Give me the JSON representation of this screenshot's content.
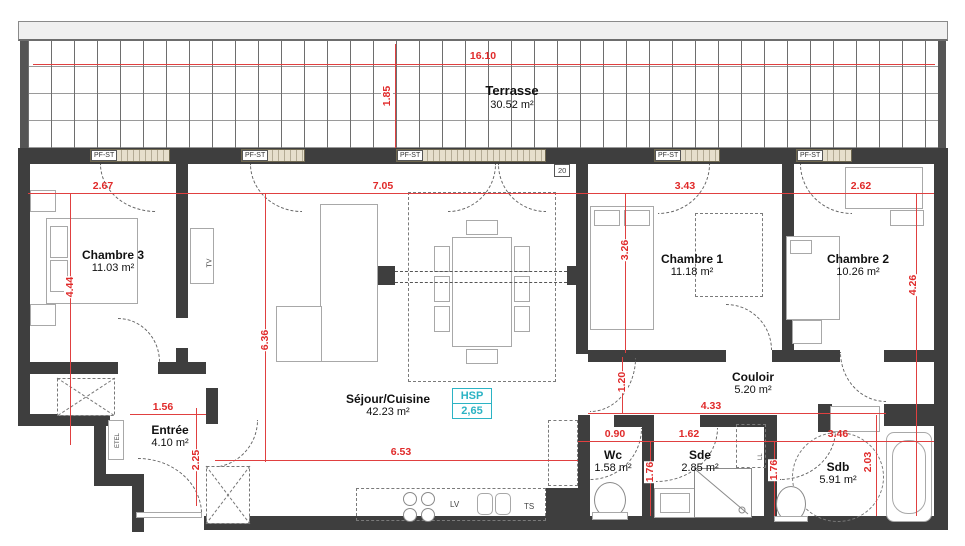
{
  "title": "Plan d'appartement 4 pièces",
  "colors": {
    "wall": "#3e3e3e",
    "dimension_red": "#e02a2a",
    "window_sill": "#e6dfcc",
    "hsp_cyan": "#2bb3c4",
    "terrace_grid": "#6e6e6e"
  },
  "rooms": {
    "terrasse": {
      "name": "Terrasse",
      "area": "30.52 m²"
    },
    "chambre3": {
      "name": "Chambre 3",
      "area": "11.03 m²"
    },
    "sejour": {
      "name": "Séjour/Cuisine",
      "area": "42.23 m²"
    },
    "chambre1": {
      "name": "Chambre 1",
      "area": "11.18 m²"
    },
    "chambre2": {
      "name": "Chambre 2",
      "area": "10.26 m²"
    },
    "couloir": {
      "name": "Couloir",
      "area": "5.20 m²"
    },
    "entree": {
      "name": "Entrée",
      "area": "4.10 m²"
    },
    "wc": {
      "name": "Wc",
      "area": "1.58 m²"
    },
    "sde": {
      "name": "Sde",
      "area": "2.85 m²"
    },
    "sdb": {
      "name": "Sdb",
      "area": "5.91 m²"
    }
  },
  "dims": [
    {
      "value": "16.10"
    },
    {
      "value": "1.85"
    },
    {
      "value": "2.67"
    },
    {
      "value": "7.05"
    },
    {
      "value": "3.43"
    },
    {
      "value": "2.62"
    },
    {
      "value": "4.44"
    },
    {
      "value": "6.36"
    },
    {
      "value": "3.26"
    },
    {
      "value": "4.26"
    },
    {
      "value": "1.56"
    },
    {
      "value": "2.25"
    },
    {
      "value": "6.53"
    },
    {
      "value": "1.20"
    },
    {
      "value": "4.33"
    },
    {
      "value": "0.90"
    },
    {
      "value": "1.62"
    },
    {
      "value": "3.46"
    },
    {
      "value": "1.76"
    },
    {
      "value": "1.76"
    },
    {
      "value": "2.03"
    }
  ],
  "windows": [
    {
      "label": "PF-ST"
    },
    {
      "label": "PF-ST"
    },
    {
      "label": "PF-ST"
    },
    {
      "label": "PF-ST"
    },
    {
      "label": "PF-ST"
    }
  ],
  "annotations": {
    "hsp_label": "HSP",
    "hsp_value": "2,65",
    "wall_thickness": "20",
    "etel": "ETEL",
    "tv": "TV",
    "lv": "LV",
    "ts": "TS",
    "ll": "LL"
  }
}
